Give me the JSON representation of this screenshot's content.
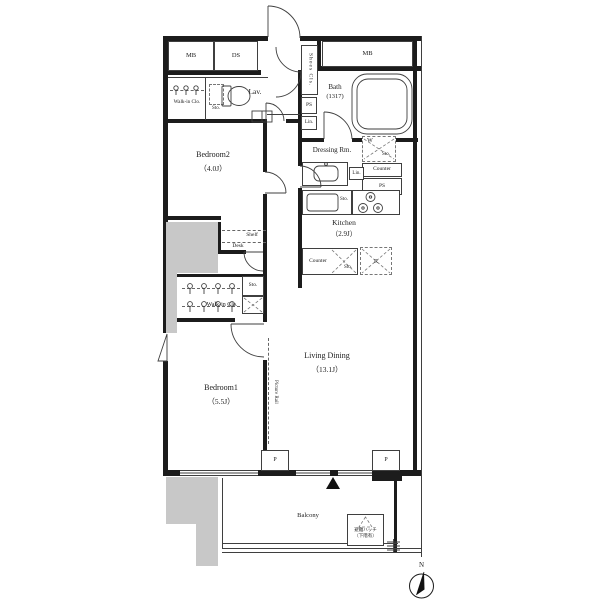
{
  "rooms": {
    "bedroom2": {
      "name": "Bedroom2",
      "size": "（4.0J）"
    },
    "bedroom1": {
      "name": "Bedroom1",
      "size": "（5.5J）"
    },
    "living_dining": {
      "name": "Living Dining",
      "size": "（13.1J）"
    },
    "kitchen": {
      "name": "Kitchen",
      "size": "（2.9J）"
    },
    "bath": {
      "name": "Bath",
      "size": "(1317)"
    },
    "dressing_room": {
      "name": "Dressing Rm."
    },
    "lavatory": {
      "name": "Lav."
    },
    "walk_in_closet": {
      "name": "Walk-in Clo."
    },
    "shoes_closet": {
      "name": "Shoes Cls."
    },
    "balcony": {
      "name": "Balcony"
    }
  },
  "labels": {
    "meter_box": "MB",
    "duct_space": "DS",
    "pipe_space": "PS",
    "linen": "Lin.",
    "storage": "Sto.",
    "washer": "W",
    "refrigerator": "R",
    "pillar": "P",
    "counter": "Counter",
    "shelf": "Shelf",
    "desk": "Desk",
    "picture_rail": "Picture Rail",
    "evacuation_hatch": "避難ハッチ",
    "evacuation_hatch_note": "（下階有）",
    "compass_north": "N"
  },
  "colors": {
    "wall": "#1c1c1c",
    "thin_line": "#3f3f3f",
    "shaded_area": "#c8c8c8",
    "background": "#ffffff"
  }
}
